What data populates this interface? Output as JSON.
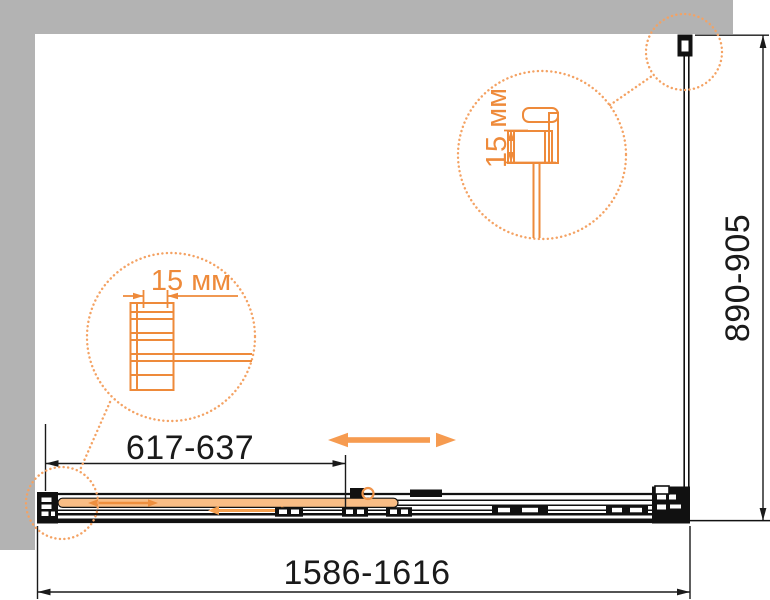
{
  "labels": {
    "door_width": "617-637",
    "total_width": "1586-1616",
    "side_depth": "890-905",
    "detail_left": "15 мм",
    "detail_right": "15 мм"
  },
  "colors": {
    "wall_gray": "#b3b3b3",
    "line_black": "#1a1a1a",
    "accent_orange": "#ee8a3a",
    "dotted_orange": "#f4a263",
    "arrow_orange": "#f69b50",
    "glass_fill": "#f9bd85"
  }
}
